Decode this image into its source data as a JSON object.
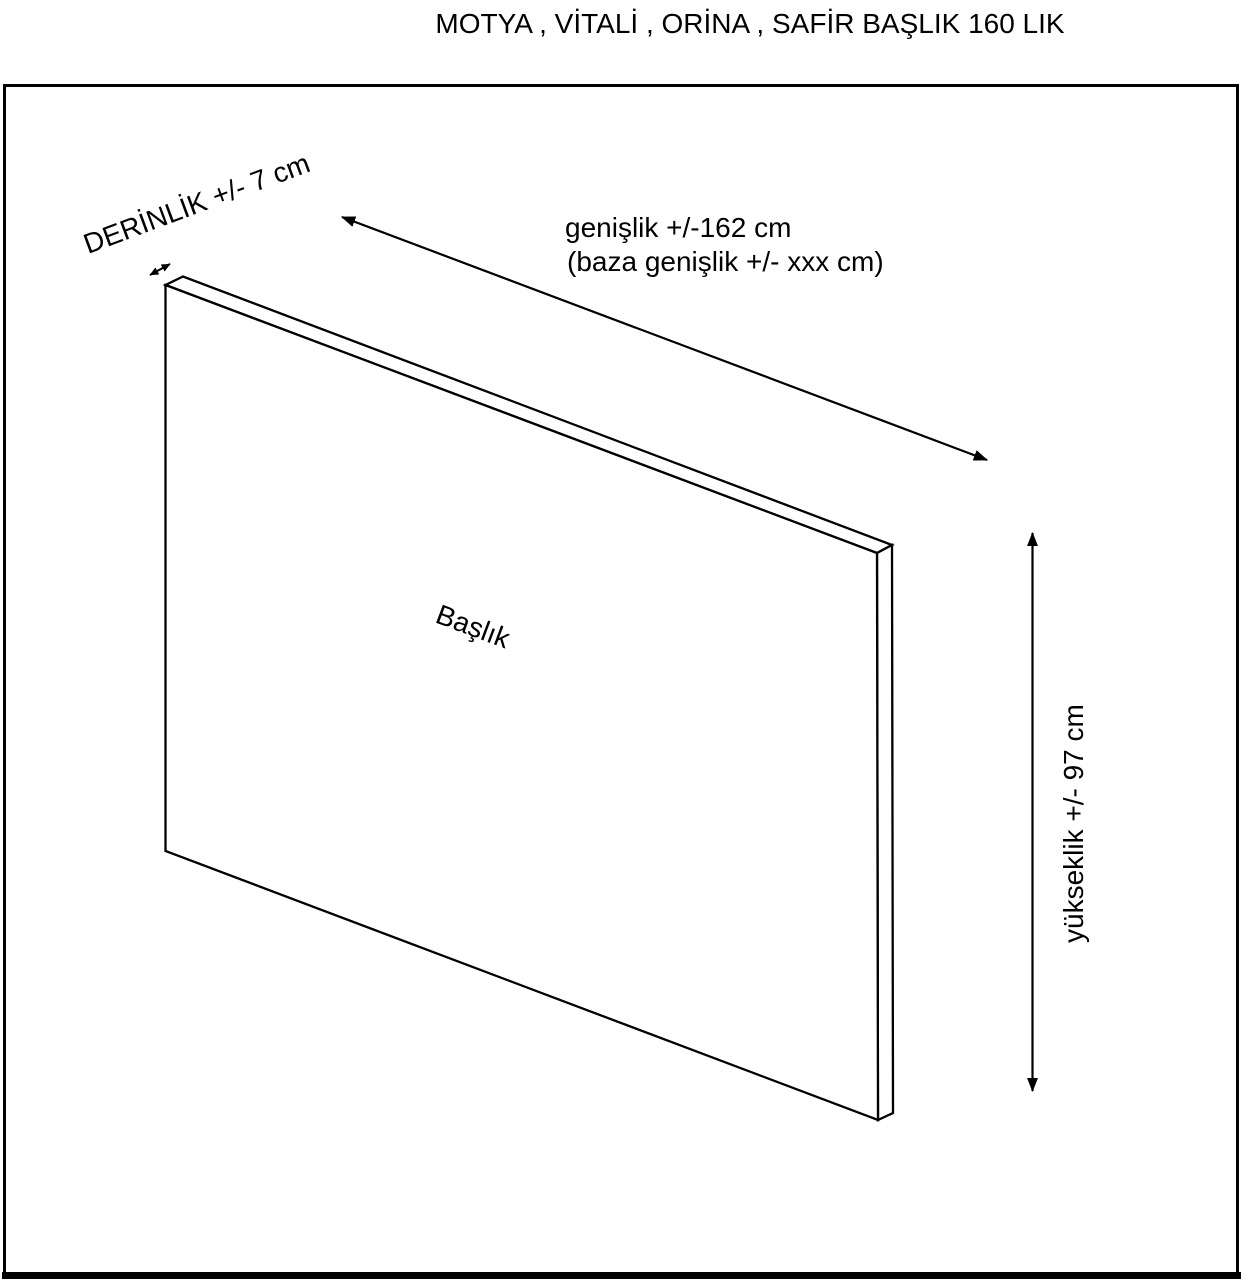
{
  "colors": {
    "background": "#ffffff",
    "line": "#000000",
    "text": "#000000"
  },
  "title": "MOTYA , VİTALİ , ORİNA , SAFİR BAŞLIK 160 LIK",
  "diagram": {
    "panel_label": "Başlık",
    "depth_label": "DERİNLİK +/- 7 cm",
    "width_label_line1": "genişlik +/-162 cm",
    "width_label_line2": "(baza genişlik +/- xxx cm)",
    "height_label": "yükseklik +/- 97 cm"
  }
}
